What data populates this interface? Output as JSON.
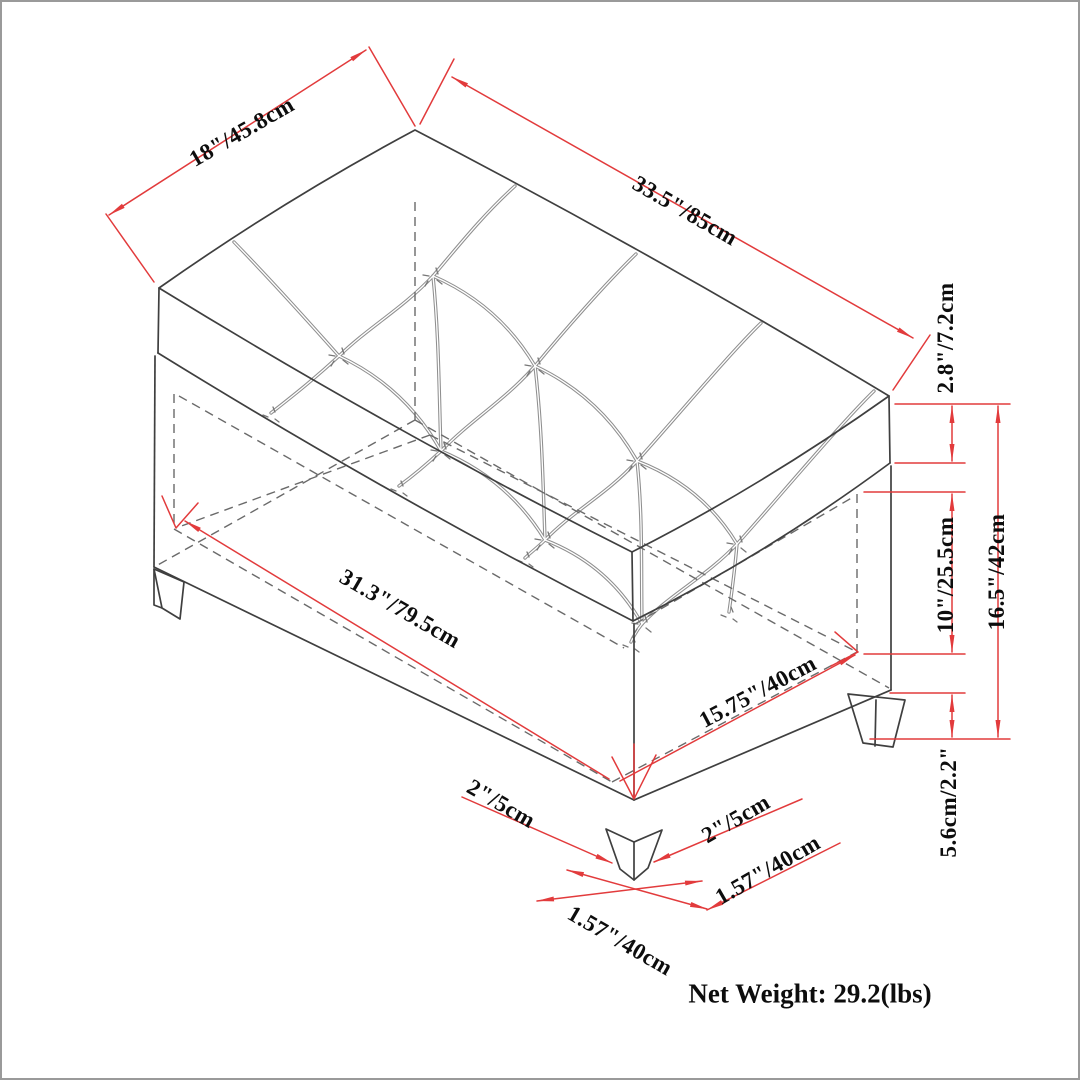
{
  "diagram": {
    "title": "storage ottoman bench dimension drawing",
    "colors": {
      "dimension_red": "#e23b3c",
      "outline_gray": "#3f3f3f",
      "hidden_gray": "#6a6a6a",
      "tuft_gray": "#8f8f8f"
    }
  },
  "dimensions": {
    "lid_depth": "18\"/45.8cm",
    "lid_length": "33.5\"/85cm",
    "lid_thickness": "2.8\"/7.2cm",
    "interior_length": "31.3\"/79.5cm",
    "interior_depth": "15.75\"/40cm",
    "interior_height": "10\"/25.5cm",
    "overall_height": "16.5\"/42cm",
    "leg_height": "5.6cm/2.2\"",
    "leg_top_left": "2\"/5cm",
    "leg_top_right": "2\"/5cm",
    "leg_foot_right": "1.57\"/40cm",
    "leg_foot_bottom": "1.57\"/40cm"
  },
  "footer": {
    "net_weight": "Net Weight: 29.2(lbs)"
  }
}
